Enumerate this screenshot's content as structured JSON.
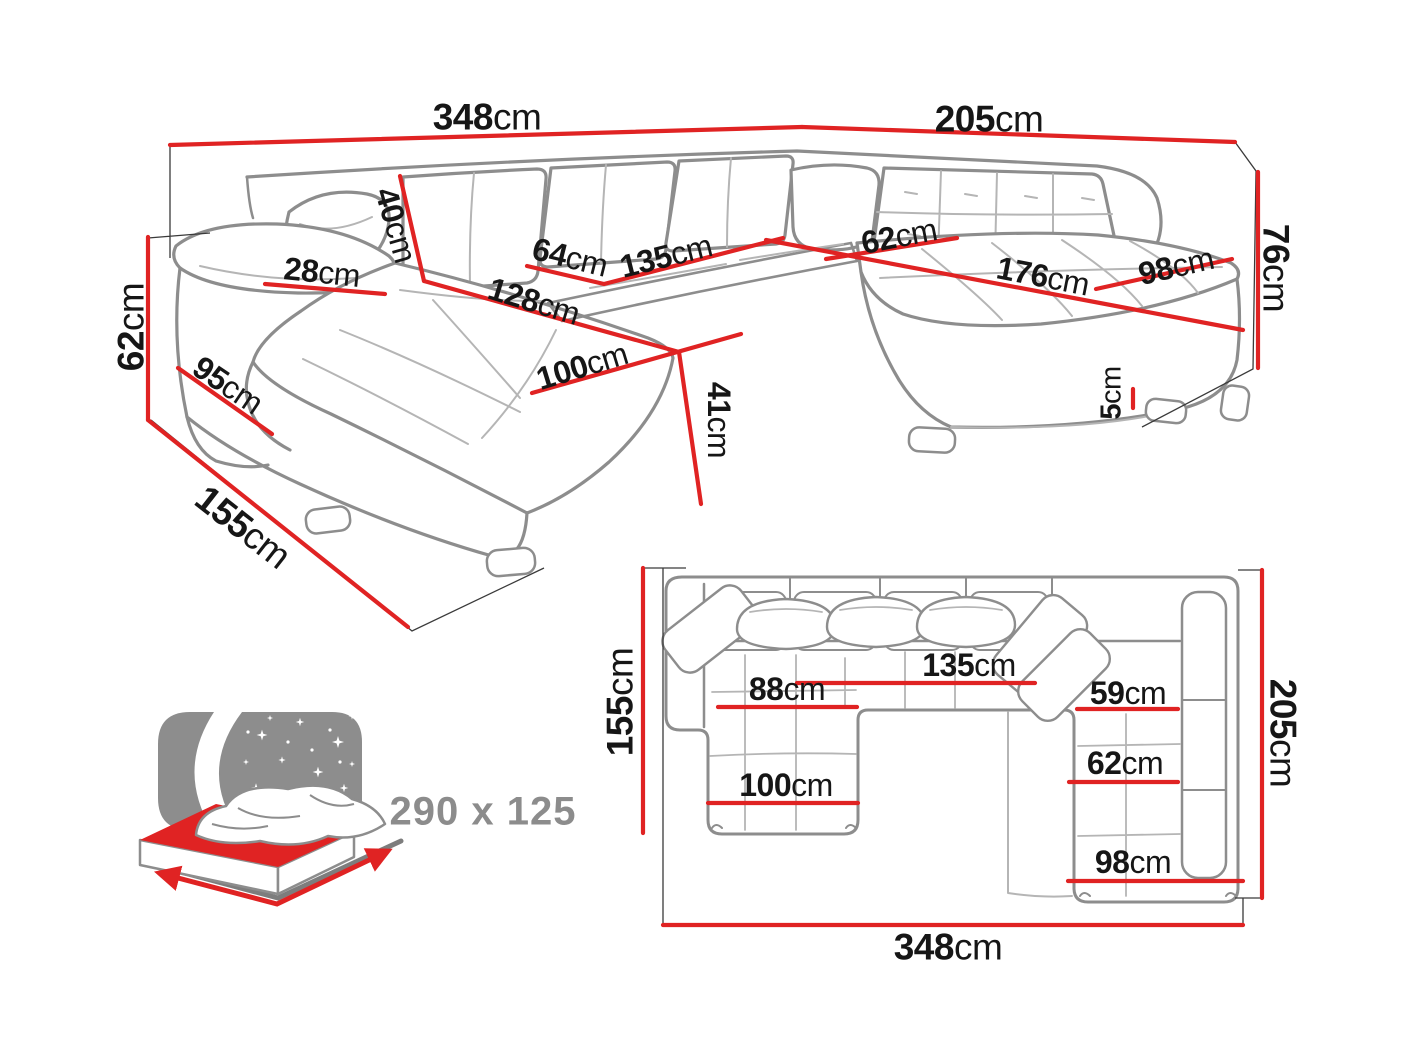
{
  "colors": {
    "dimension_red": "#e02323",
    "outline_gray": "#8d8d8d",
    "label_black": "#161616",
    "bed_text_gray": "#8c8c8c"
  },
  "perspective": {
    "back_width": {
      "value": "348",
      "unit": "cm"
    },
    "right_side_width": {
      "value": "205",
      "unit": "cm"
    },
    "total_height": {
      "value": "76",
      "unit": "cm"
    },
    "arm_height": {
      "value": "62",
      "unit": "cm"
    },
    "floor_depth": {
      "value": "155",
      "unit": "cm"
    },
    "arm_side": {
      "value": "95",
      "unit": "cm"
    },
    "arm_top_width": {
      "value": "28",
      "unit": "cm"
    },
    "back_cushion": {
      "value": "40",
      "unit": "cm"
    },
    "seat_depth": {
      "value": "64",
      "unit": "cm"
    },
    "mid_seat_width": {
      "value": "135",
      "unit": "cm"
    },
    "chaise_length": {
      "value": "128",
      "unit": "cm"
    },
    "chaise_width": {
      "value": "100",
      "unit": "cm"
    },
    "seat_height": {
      "value": "41",
      "unit": "cm"
    },
    "corner_seat_depth": {
      "value": "62",
      "unit": "cm"
    },
    "right_seat_length": {
      "value": "176",
      "unit": "cm"
    },
    "right_seat_width": {
      "value": "98",
      "unit": "cm"
    },
    "leg_height": {
      "value": "5",
      "unit": "cm"
    }
  },
  "plan": {
    "left_depth": {
      "value": "155",
      "unit": "cm"
    },
    "right_depth": {
      "value": "205",
      "unit": "cm"
    },
    "total_width": {
      "value": "348",
      "unit": "cm"
    },
    "chaise_inner": {
      "value": "88",
      "unit": "cm"
    },
    "mid_seat_width": {
      "value": "135",
      "unit": "cm"
    },
    "right_inner": {
      "value": "59",
      "unit": "cm"
    },
    "chaise_width": {
      "value": "100",
      "unit": "cm"
    },
    "right_seat_depth": {
      "value": "62",
      "unit": "cm"
    },
    "right_seat_width": {
      "value": "98",
      "unit": "cm"
    }
  },
  "bed": {
    "sleeping_size": "290 x 125"
  }
}
